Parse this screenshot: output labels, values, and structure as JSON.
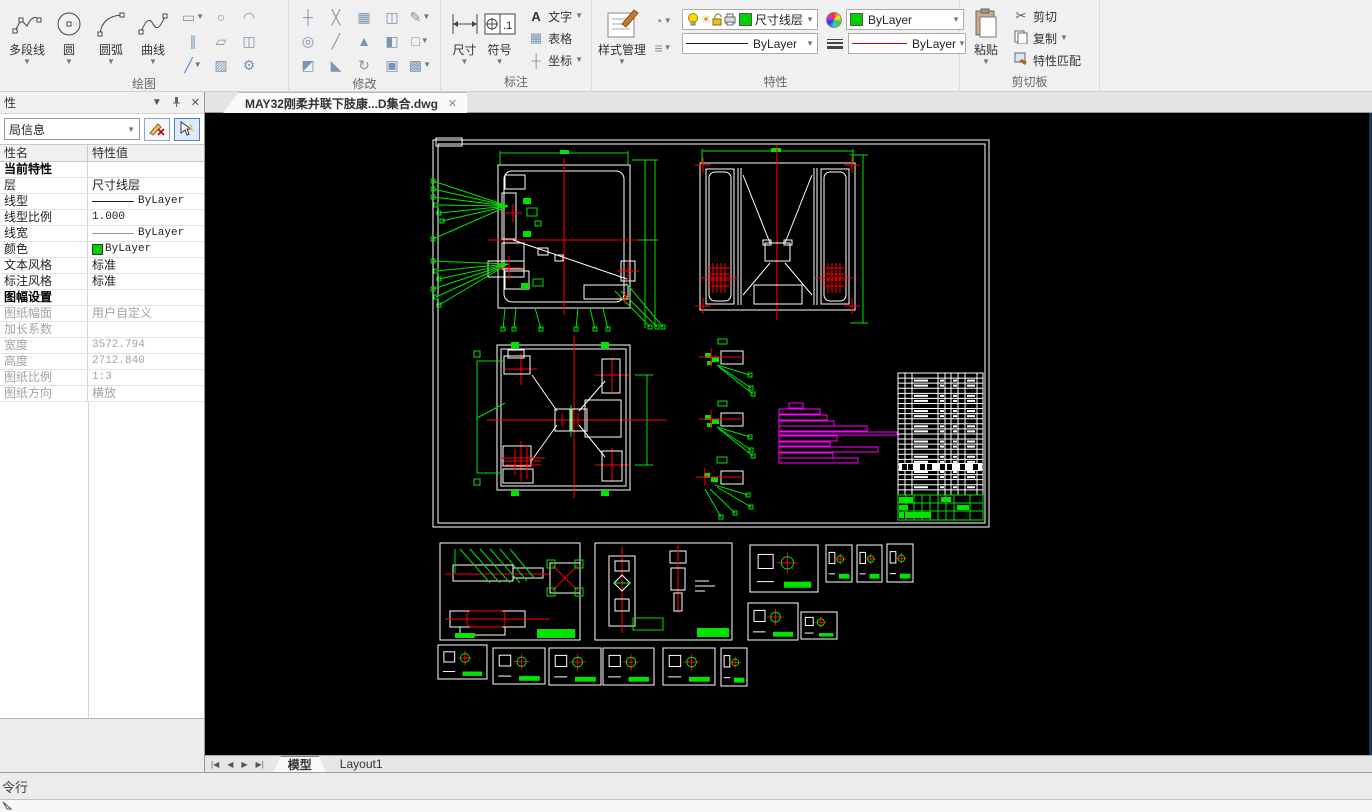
{
  "ribbon": {
    "draw": {
      "label": "绘图",
      "buttons": [
        "多段线",
        "圆",
        "圆弧",
        "曲线"
      ]
    },
    "modify": {
      "label": "修改"
    },
    "annotate": {
      "label": "标注",
      "dim": "尺寸",
      "symbol": "符号",
      "text": "文字",
      "table": "表格",
      "coord": "坐标"
    },
    "properties": {
      "label": "特性",
      "style_manager": "样式管理",
      "layer": "尺寸线层",
      "linetype": "ByLayer",
      "color": "ByLayer",
      "lineweight": "ByLayer"
    },
    "clipboard": {
      "label": "剪切板",
      "paste": "粘贴",
      "cut": "剪切",
      "copy": "复制",
      "match": "特性匹配"
    }
  },
  "doc_tab": {
    "title": "MAY32刚柔并联下肢康...D集合.dwg",
    "close": "✕"
  },
  "panel": {
    "title": "性",
    "filter_value": "局信息",
    "col_name": "性名",
    "col_value": "特性值",
    "rows": [
      {
        "name": "当前特性",
        "value": "",
        "type": "section"
      },
      {
        "name": "层",
        "value": "尺寸线层",
        "type": "text"
      },
      {
        "name": "线型",
        "value": "ByLayer",
        "type": "linetype"
      },
      {
        "name": "线型比例",
        "value": "1.000",
        "type": "mono"
      },
      {
        "name": "线宽",
        "value": "ByLayer",
        "type": "lineweight"
      },
      {
        "name": "颜色",
        "value": "ByLayer",
        "type": "color"
      },
      {
        "name": "文本风格",
        "value": "标准",
        "type": "text"
      },
      {
        "name": "标注风格",
        "value": "标准",
        "type": "text"
      },
      {
        "name": "图幅设置",
        "value": "",
        "type": "section"
      },
      {
        "name": "图纸幅面",
        "value": "用户自定义",
        "type": "disabled"
      },
      {
        "name": "加长系数",
        "value": "",
        "type": "disabled"
      },
      {
        "name": "宽度",
        "value": "3572.794",
        "type": "disabled-mono"
      },
      {
        "name": "高度",
        "value": "2712.840",
        "type": "disabled-mono"
      },
      {
        "name": "图纸比例",
        "value": "1:3",
        "type": "disabled-mono"
      },
      {
        "name": "图纸方向",
        "value": "横放",
        "type": "disabled"
      }
    ]
  },
  "sheet_tabs": {
    "model": "模型",
    "layout": "Layout1"
  },
  "command_bar": {
    "prompt": "令行"
  },
  "canvas": {
    "description": "CAD drawing sheet: assembly views with dimension leaders, detail views, BOM table",
    "colors": {
      "background": "#000000",
      "outline": "#ffffff",
      "dimension": "#00e400",
      "centerline": "#ff0000",
      "highlight": "#ff00ff"
    }
  }
}
